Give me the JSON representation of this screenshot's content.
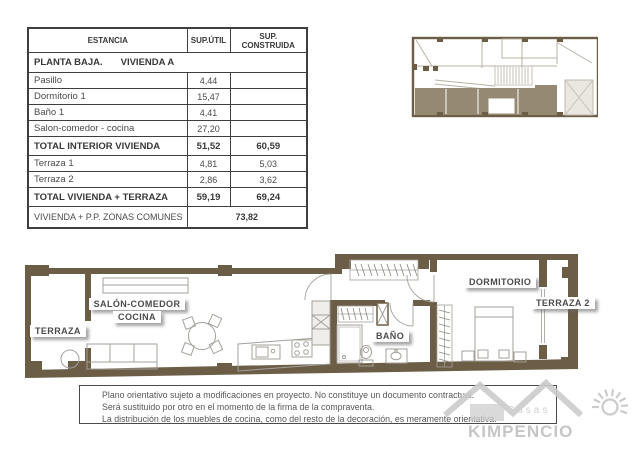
{
  "colors": {
    "wall": "#6c5d46",
    "key_plan_highlight": "#958973",
    "furniture_line": "#a3a09a",
    "table_border": "#3e3e3e",
    "label_text": "#4b4b4b",
    "watermark_gray": "#c8c8c8"
  },
  "area_table": {
    "headers": [
      "ESTANCIA",
      "SUP.ÚTIL",
      "SUP. CONSTRUIDA"
    ],
    "section_left": "PLANTA BAJA.",
    "section_right": "VIVIENDA A",
    "rows": [
      {
        "label": "Pasillo",
        "util": "4,44",
        "construida": "",
        "bold": false
      },
      {
        "label": "Dormitorio 1",
        "util": "15,47",
        "construida": "",
        "bold": false
      },
      {
        "label": "Baño 1",
        "util": "4,41",
        "construida": "",
        "bold": false
      },
      {
        "label": "Salon-comedor - cocina",
        "util": "27,20",
        "construida": "",
        "bold": false
      },
      {
        "label": "TOTAL INTERIOR VIVIENDA",
        "util": "51,52",
        "construida": "60,59",
        "bold": true
      },
      {
        "label": "Terraza 1",
        "util": "4,81",
        "construida": "5,03",
        "bold": false
      },
      {
        "label": "Terraza 2",
        "util": "2,86",
        "construida": "3,62",
        "bold": false
      },
      {
        "label": "TOTAL VIVIENDA + TERRAZA",
        "util": "59,19",
        "construida": "69,24",
        "bold": true
      }
    ],
    "footer_label": "VIVIENDA + P.P. ZONAS COMUNES",
    "footer_value": "73,82"
  },
  "floor_plan_labels": {
    "terraza1": "TERRAZA",
    "salon_line1": "SALÓN-COMEDOR",
    "salon_line2": "COCINA",
    "bano": "BAÑO",
    "dormitorio": "DORMITORIO",
    "terraza2": "TERRAZA 2"
  },
  "disclaimer": {
    "lines": [
      "Plano orientativo sujeto a modificaciones en proyecto. No constituye un documento contractual.",
      "Será sustituido por otro en el momento de la firma de la compraventa.",
      "La distribución de los muebles de cocina, como del resto de la decoración, es meramente orientativa."
    ]
  },
  "watermark": {
    "top": "Casas",
    "brand": "KIMPENCIO"
  }
}
